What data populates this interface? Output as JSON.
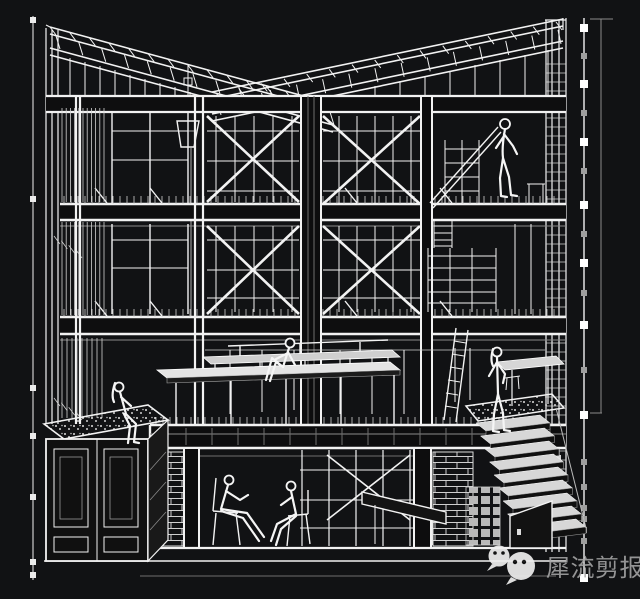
{
  "canvas": {
    "width": 640,
    "height": 599
  },
  "colors": {
    "background": "#111214",
    "line": "#f2f2f2",
    "dim_marks": "#9e9e9e",
    "watermark_text_color": "#a8a8a8",
    "watermark_bubble_color": "#efefef"
  },
  "watermark": {
    "text": "犀流剪报",
    "icons": [
      "wechat-bubble-small",
      "wechat-bubble-large"
    ]
  },
  "scene": {
    "type": "architectural sectional axonometric line drawing, white on black",
    "levels": [
      "butterfly roof trusses",
      "upper floor",
      "middle floor",
      "ground floor platform",
      "basement"
    ],
    "figures": [
      "person standing on upper mezzanine",
      "person sitting on ground-floor platform bench",
      "person standing at stair landing",
      "person sitting on planter edge",
      "person seated on chair (basement left)",
      "person seated on chair (basement right)"
    ]
  }
}
